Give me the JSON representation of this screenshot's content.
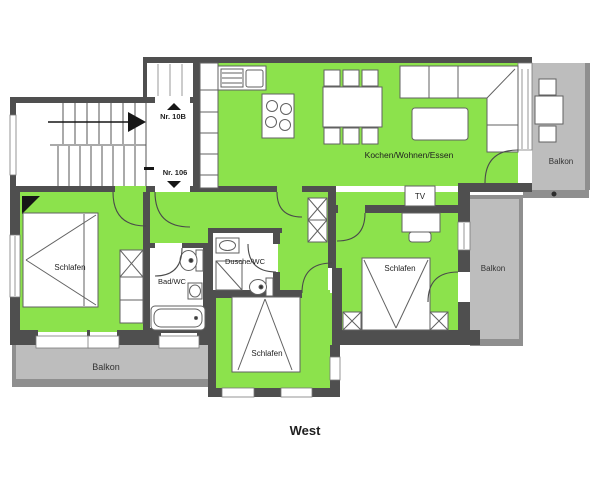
{
  "plan": {
    "compass_label": "West",
    "unit_labels": {
      "upper": "Nr. 10B",
      "lower": "Nr. 106"
    },
    "rooms": {
      "kitchen_living_dining": "Kochen/Wohnen/Essen",
      "bedroom_left": "Schlafen",
      "bedroom_right": "Schlafen",
      "bedroom_bottom": "Schlafen",
      "bath_wc": "Bad/WC",
      "shower_wc": "Dusche/WC"
    },
    "fixtures": {
      "tv": "TV"
    },
    "balconies": {
      "top_right": "Balkon",
      "mid_right": "Balkon",
      "bottom_left": "Balkon"
    },
    "colors": {
      "apartment_fill": "#8ce24c",
      "balcony_fill": "#bdbdbd",
      "balcony_border": "#8f8f8f",
      "wall": "#4f4f4f",
      "text": "#1f1f1f"
    }
  }
}
